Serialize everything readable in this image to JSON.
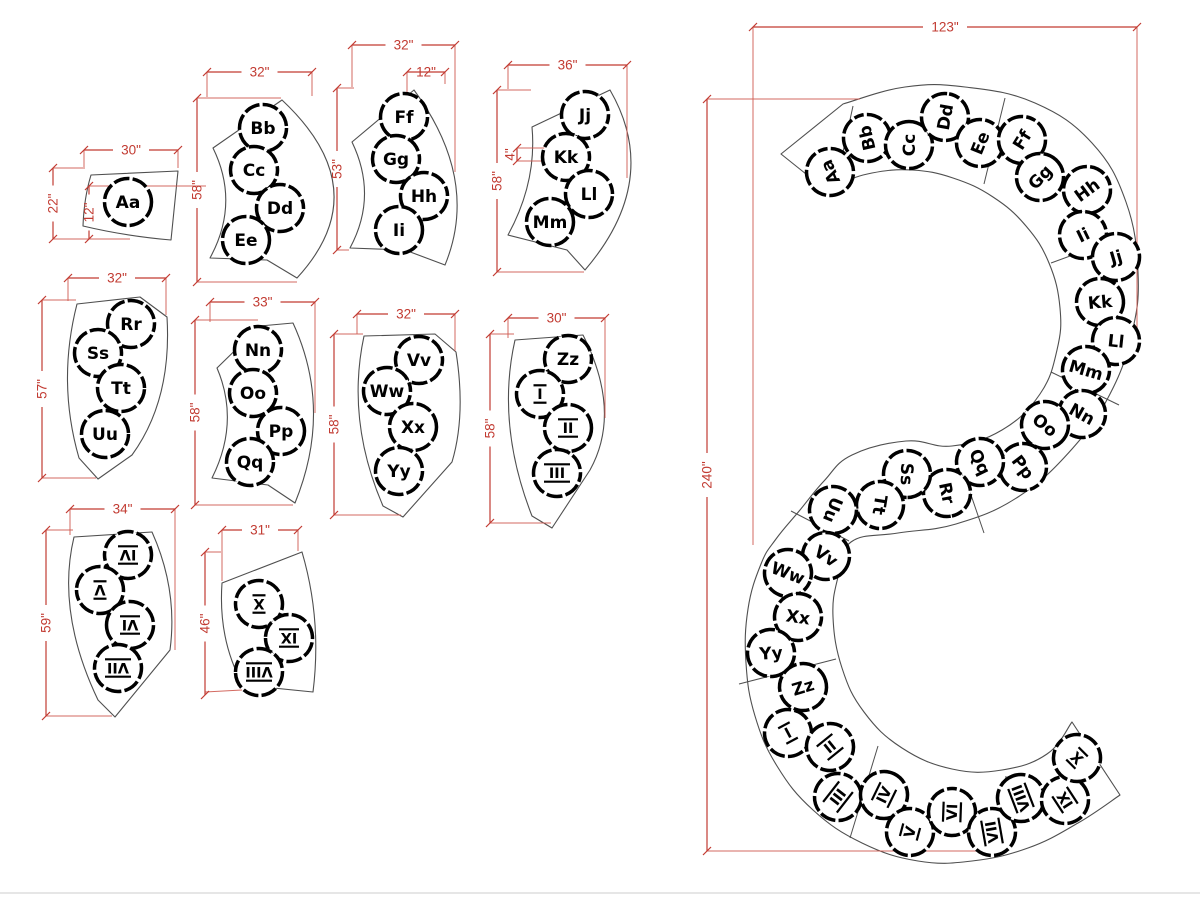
{
  "title": "Curved desk segment layout with S-shaped assembly",
  "colors": {
    "dim_red": "#c23b32",
    "aux_red": "#cf5a50",
    "outline_gray": "#4f4f4f",
    "seat_ring": "#000000",
    "frame_gray": "#cccccc",
    "background": "#ffffff"
  },
  "parts": [
    {
      "id": "part-aa",
      "seats": [
        {
          "label": "Aa",
          "x": 128,
          "y": 202,
          "rot": 0
        }
      ],
      "dims": [
        {
          "label": "30\"",
          "x1": 84,
          "y1": 150,
          "x2": 178,
          "y2": 150,
          "aux": [
            [
              84,
              150,
              84,
              167
            ],
            [
              178,
              150,
              178,
              168
            ]
          ]
        },
        {
          "label": "22\"",
          "x1": 53,
          "y1": 168,
          "x2": 53,
          "y2": 239,
          "aux": [
            [
              53,
              168,
              85,
              168
            ],
            [
              53,
              239,
              130,
              239
            ]
          ]
        },
        {
          "label": "12\"",
          "x1": 89,
          "y1": 186,
          "x2": 89,
          "y2": 239,
          "aux": [
            [
              89,
              186,
              206,
              186
            ]
          ]
        }
      ]
    },
    {
      "id": "part-bb-ee",
      "seats": [
        {
          "label": "Bb",
          "x": 263,
          "y": 128,
          "rot": 0
        },
        {
          "label": "Cc",
          "x": 254,
          "y": 170,
          "rot": 0
        },
        {
          "label": "Dd",
          "x": 280,
          "y": 208,
          "rot": 0
        },
        {
          "label": "Ee",
          "x": 246,
          "y": 240,
          "rot": 0
        }
      ],
      "dims": [
        {
          "label": "32\"",
          "x1": 207,
          "y1": 72,
          "x2": 312,
          "y2": 72,
          "aux": [
            [
              207,
              72,
              207,
              97
            ],
            [
              312,
              72,
              312,
              96
            ]
          ]
        },
        {
          "label": "58\"",
          "x1": 197,
          "y1": 98,
          "x2": 197,
          "y2": 282,
          "aux": [
            [
              197,
              98,
              281,
              98
            ],
            [
              197,
              282,
              297,
              282
            ]
          ]
        }
      ]
    },
    {
      "id": "part-ff-ii",
      "seats": [
        {
          "label": "Ff",
          "x": 404,
          "y": 117,
          "rot": 0
        },
        {
          "label": "Gg",
          "x": 396,
          "y": 159,
          "rot": 0
        },
        {
          "label": "Hh",
          "x": 424,
          "y": 196,
          "rot": 0
        },
        {
          "label": "Ii",
          "x": 399,
          "y": 230,
          "rot": 0
        }
      ],
      "dims": [
        {
          "label": "32\"",
          "x1": 352,
          "y1": 45,
          "x2": 455,
          "y2": 45,
          "aux": [
            [
              352,
              45,
              352,
              87
            ],
            [
              455,
              45,
              455,
              172
            ]
          ]
        },
        {
          "label": "12\"",
          "x1": 407,
          "y1": 72,
          "x2": 445,
          "y2": 72,
          "aux": [
            [
              407,
              72,
              407,
              156
            ],
            [
              445,
              72,
              445,
              84
            ]
          ]
        },
        {
          "label": "53\"",
          "x1": 337,
          "y1": 88,
          "x2": 337,
          "y2": 250,
          "aux": [
            [
              337,
              88,
              354,
              88
            ],
            [
              337,
              250,
              349,
              250
            ]
          ]
        }
      ]
    },
    {
      "id": "part-jj-mm",
      "seats": [
        {
          "label": "Jj",
          "x": 585,
          "y": 115,
          "rot": 0
        },
        {
          "label": "Kk",
          "x": 566,
          "y": 157,
          "rot": 0
        },
        {
          "label": "Ll",
          "x": 589,
          "y": 194,
          "rot": 0
        },
        {
          "label": "Mm",
          "x": 550,
          "y": 222,
          "rot": 0
        }
      ],
      "dims": [
        {
          "label": "36\"",
          "x1": 508,
          "y1": 65,
          "x2": 627,
          "y2": 65,
          "aux": [
            [
              508,
              65,
              508,
              89
            ],
            [
              627,
              65,
              627,
              178
            ]
          ]
        },
        {
          "label": "58\"",
          "x1": 497,
          "y1": 90,
          "x2": 497,
          "y2": 272,
          "aux": [
            [
              497,
              90,
              531,
              90
            ],
            [
              497,
              272,
              584,
              272
            ]
          ]
        },
        {
          "label": "4\"",
          "x1": 517,
          "y1": 148,
          "x2": 517,
          "y2": 161,
          "side": "left",
          "aux": [
            [
              517,
              148,
              545,
              148
            ],
            [
              517,
              161,
              545,
              161
            ]
          ]
        }
      ]
    },
    {
      "id": "part-rr-uu",
      "seats": [
        {
          "label": "Rr",
          "x": 131,
          "y": 324,
          "rot": 0
        },
        {
          "label": "Ss",
          "x": 98,
          "y": 353,
          "rot": 0
        },
        {
          "label": "Tt",
          "x": 121,
          "y": 388,
          "rot": 0
        },
        {
          "label": "Uu",
          "x": 105,
          "y": 434,
          "rot": 0
        }
      ],
      "dims": [
        {
          "label": "32\"",
          "x1": 68,
          "y1": 278,
          "x2": 166,
          "y2": 278,
          "aux": [
            [
              68,
              278,
              68,
              301
            ],
            [
              166,
              278,
              166,
              315
            ]
          ]
        },
        {
          "label": "57\"",
          "x1": 42,
          "y1": 300,
          "x2": 42,
          "y2": 478,
          "aux": [
            [
              42,
              300,
              76,
              300
            ],
            [
              42,
              478,
              96,
              478
            ]
          ]
        }
      ]
    },
    {
      "id": "part-nn-qq",
      "seats": [
        {
          "label": "Nn",
          "x": 258,
          "y": 350,
          "rot": 0
        },
        {
          "label": "Oo",
          "x": 253,
          "y": 393,
          "rot": 0
        },
        {
          "label": "Pp",
          "x": 281,
          "y": 431,
          "rot": 0
        },
        {
          "label": "Qq",
          "x": 250,
          "y": 462,
          "rot": 0
        }
      ],
      "dims": [
        {
          "label": "33\"",
          "x1": 210,
          "y1": 302,
          "x2": 315,
          "y2": 302,
          "aux": [
            [
              210,
              302,
              210,
              322
            ],
            [
              315,
              302,
              315,
              413
            ]
          ]
        },
        {
          "label": "58\"",
          "x1": 195,
          "y1": 320,
          "x2": 195,
          "y2": 505,
          "aux": [
            [
              195,
              320,
              258,
              320
            ],
            [
              195,
              505,
              293,
              505
            ]
          ]
        }
      ]
    },
    {
      "id": "part-vv-yy",
      "seats": [
        {
          "label": "Vv",
          "x": 419,
          "y": 360,
          "rot": 0
        },
        {
          "label": "Ww",
          "x": 387,
          "y": 391,
          "rot": 0
        },
        {
          "label": "Xx",
          "x": 413,
          "y": 427,
          "rot": 0
        },
        {
          "label": "Yy",
          "x": 399,
          "y": 471,
          "rot": 0
        }
      ],
      "dims": [
        {
          "label": "32\"",
          "x1": 357,
          "y1": 314,
          "x2": 455,
          "y2": 314,
          "aux": [
            [
              357,
              314,
              357,
              334
            ],
            [
              455,
              314,
              455,
              351
            ]
          ]
        },
        {
          "label": "58\"",
          "x1": 334,
          "y1": 334,
          "x2": 334,
          "y2": 515,
          "aux": [
            [
              334,
              334,
              363,
              334
            ],
            [
              334,
              515,
              401,
              515
            ]
          ]
        }
      ]
    },
    {
      "id": "part-zz-iii",
      "seats": [
        {
          "label": "Zz",
          "x": 568,
          "y": 359,
          "rot": 0
        },
        {
          "label": "I",
          "x": 540,
          "y": 394,
          "rot": 0
        },
        {
          "label": "II",
          "x": 568,
          "y": 428,
          "rot": 0
        },
        {
          "label": "III",
          "x": 557,
          "y": 473,
          "rot": 0
        }
      ],
      "dims": [
        {
          "label": "30\"",
          "x1": 508,
          "y1": 318,
          "x2": 605,
          "y2": 318,
          "aux": [
            [
              508,
              318,
              508,
              338
            ],
            [
              605,
              318,
              605,
              418
            ]
          ]
        },
        {
          "label": "58\"",
          "x1": 490,
          "y1": 334,
          "x2": 490,
          "y2": 523,
          "aux": [
            [
              490,
              334,
              514,
              334
            ],
            [
              490,
              523,
              551,
              523
            ]
          ]
        }
      ]
    },
    {
      "id": "part-iv-vii",
      "seats": [
        {
          "label": "IV",
          "x": 128,
          "y": 555,
          "rot": 180
        },
        {
          "label": "V",
          "x": 100,
          "y": 590,
          "rot": 180
        },
        {
          "label": "VI",
          "x": 130,
          "y": 625,
          "rot": 180
        },
        {
          "label": "VII",
          "x": 118,
          "y": 668,
          "rot": 180
        }
      ],
      "dims": [
        {
          "label": "34\"",
          "x1": 70,
          "y1": 509,
          "x2": 175,
          "y2": 509,
          "aux": [
            [
              70,
              509,
              70,
              535
            ],
            [
              175,
              509,
              175,
              650
            ]
          ]
        },
        {
          "label": "59\"",
          "x1": 46,
          "y1": 530,
          "x2": 46,
          "y2": 716,
          "aux": [
            [
              46,
              530,
              73,
              530
            ],
            [
              46,
              716,
              112,
              716
            ]
          ]
        }
      ]
    },
    {
      "id": "part-viii-x",
      "seats": [
        {
          "label": "X",
          "x": 259,
          "y": 604,
          "rot": 180
        },
        {
          "label": "IX",
          "x": 289,
          "y": 638,
          "rot": 180
        },
        {
          "label": "VIII",
          "x": 259,
          "y": 672,
          "rot": 180
        }
      ],
      "dims": [
        {
          "label": "31\"",
          "x1": 222,
          "y1": 530,
          "x2": 298,
          "y2": 530,
          "aux": [
            [
              222,
              530,
              222,
              581
            ],
            [
              298,
              530,
              298,
              551
            ]
          ]
        },
        {
          "label": "46\"",
          "x1": 205,
          "y1": 552,
          "x2": 205,
          "y2": 695,
          "aux": [
            [
              205,
              552,
              221,
              552
            ],
            [
              205,
              692,
              242,
              690
            ]
          ]
        }
      ]
    }
  ],
  "assembly": {
    "seats": [
      {
        "label": "Aa",
        "x": 830,
        "y": 172,
        "rot": -113
      },
      {
        "label": "Bb",
        "x": 867,
        "y": 138,
        "rot": -103
      },
      {
        "label": "Cc",
        "x": 909,
        "y": 145,
        "rot": -90
      },
      {
        "label": "Dd",
        "x": 945,
        "y": 117,
        "rot": -80
      },
      {
        "label": "Ee",
        "x": 980,
        "y": 143,
        "rot": -68
      },
      {
        "label": "Ff",
        "x": 1022,
        "y": 140,
        "rot": -58
      },
      {
        "label": "Gg",
        "x": 1040,
        "y": 177,
        "rot": -47
      },
      {
        "label": "Hh",
        "x": 1087,
        "y": 190,
        "rot": -36
      },
      {
        "label": "Ii",
        "x": 1083,
        "y": 235,
        "rot": -26
      },
      {
        "label": "Jj",
        "x": 1116,
        "y": 257,
        "rot": -16
      },
      {
        "label": "Kk",
        "x": 1100,
        "y": 302,
        "rot": -5
      },
      {
        "label": "Ll",
        "x": 1116,
        "y": 341,
        "rot": 6
      },
      {
        "label": "Mm",
        "x": 1086,
        "y": 370,
        "rot": 16
      },
      {
        "label": "Nn",
        "x": 1082,
        "y": 414,
        "rot": 29
      },
      {
        "label": "Oo",
        "x": 1045,
        "y": 425,
        "rot": 38
      },
      {
        "label": "Pp",
        "x": 1023,
        "y": 467,
        "rot": 53
      },
      {
        "label": "Qq",
        "x": 980,
        "y": 462,
        "rot": 64
      },
      {
        "label": "Rr",
        "x": 947,
        "y": 493,
        "rot": 78
      },
      {
        "label": "Ss",
        "x": 907,
        "y": 474,
        "rot": 91
      },
      {
        "label": "Tt",
        "x": 880,
        "y": 505,
        "rot": 99
      },
      {
        "label": "Uu",
        "x": 833,
        "y": 510,
        "rot": 112
      },
      {
        "label": "Vv",
        "x": 826,
        "y": 556,
        "rot": 34
      },
      {
        "label": "Ww",
        "x": 788,
        "y": 573,
        "rot": 21
      },
      {
        "label": "Xx",
        "x": 798,
        "y": 617,
        "rot": 8
      },
      {
        "label": "Yy",
        "x": 771,
        "y": 653,
        "rot": -4
      },
      {
        "label": "Zz",
        "x": 803,
        "y": 687,
        "rot": -17
      },
      {
        "label": "I",
        "x": 788,
        "y": 733,
        "rot": -28
      },
      {
        "label": "II",
        "x": 830,
        "y": 747,
        "rot": -39
      },
      {
        "label": "III",
        "x": 838,
        "y": 797,
        "rot": -52
      },
      {
        "label": "IV",
        "x": 884,
        "y": 795,
        "rot": -64
      },
      {
        "label": "V",
        "x": 910,
        "y": 832,
        "rot": -75
      },
      {
        "label": "VI",
        "x": 952,
        "y": 812,
        "rot": -88
      },
      {
        "label": "VII",
        "x": 992,
        "y": 832,
        "rot": -100
      },
      {
        "label": "VIII",
        "x": 1021,
        "y": 798,
        "rot": -111
      },
      {
        "label": "IX",
        "x": 1065,
        "y": 800,
        "rot": -123
      },
      {
        "label": "X",
        "x": 1077,
        "y": 758,
        "rot": -135
      }
    ],
    "dims": [
      {
        "label": "123\"",
        "x1": 753,
        "y1": 27,
        "x2": 1137,
        "y2": 27,
        "aux": [
          [
            753,
            27,
            753,
            545
          ],
          [
            1137,
            27,
            1137,
            345
          ]
        ]
      },
      {
        "label": "240\"",
        "x1": 707,
        "y1": 99,
        "x2": 707,
        "y2": 851,
        "aux": [
          [
            707,
            99,
            860,
            99
          ],
          [
            707,
            851,
            988,
            851
          ]
        ]
      }
    ]
  }
}
